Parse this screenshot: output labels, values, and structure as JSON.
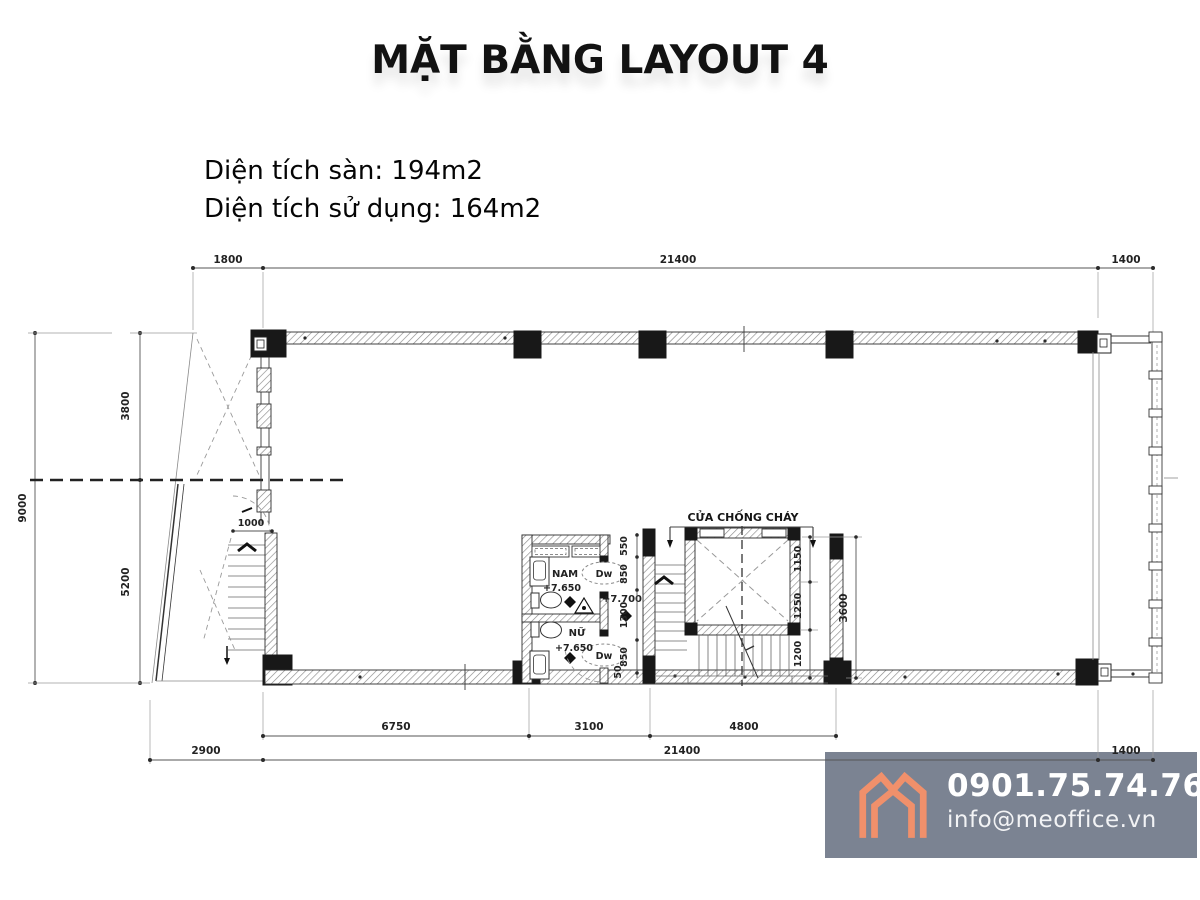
{
  "title": "MẶT BẰNG LAYOUT 4",
  "info": {
    "floor_area": "Diện tích sàn: 194m2",
    "usable_area": "Diện tích sử dụng: 164m2"
  },
  "plan": {
    "dims": {
      "top": [
        "1800",
        "21400",
        "1400"
      ],
      "left_total": "9000",
      "left": [
        "3800",
        "5200"
      ],
      "stair_width": "1000",
      "wc_chain": [
        "550",
        "850",
        "1300",
        "850",
        "50"
      ],
      "lift_chain": [
        "1150",
        "1250",
        "1200"
      ],
      "lift_total": "3600",
      "bottom_upper": [
        "6750",
        "3100",
        "4800"
      ],
      "bottom": [
        "2900",
        "21400",
        "1400"
      ]
    },
    "labels": {
      "fire_door": "CỬA CHỐNG CHÁY",
      "male_wc": "NAM",
      "male_level": "+7.650",
      "female_wc": "NỮ",
      "female_level": "+7.650",
      "hall_level": "+7.700",
      "door_nam": "Dw",
      "door_nu": "Dw"
    }
  },
  "footer": {
    "phone": "0901.75.74.76",
    "email": "info@meoffice.vn"
  },
  "colors": {
    "accent": "#f0906b",
    "footer_bg": "#7b8392",
    "line": "#3c3c3c"
  }
}
